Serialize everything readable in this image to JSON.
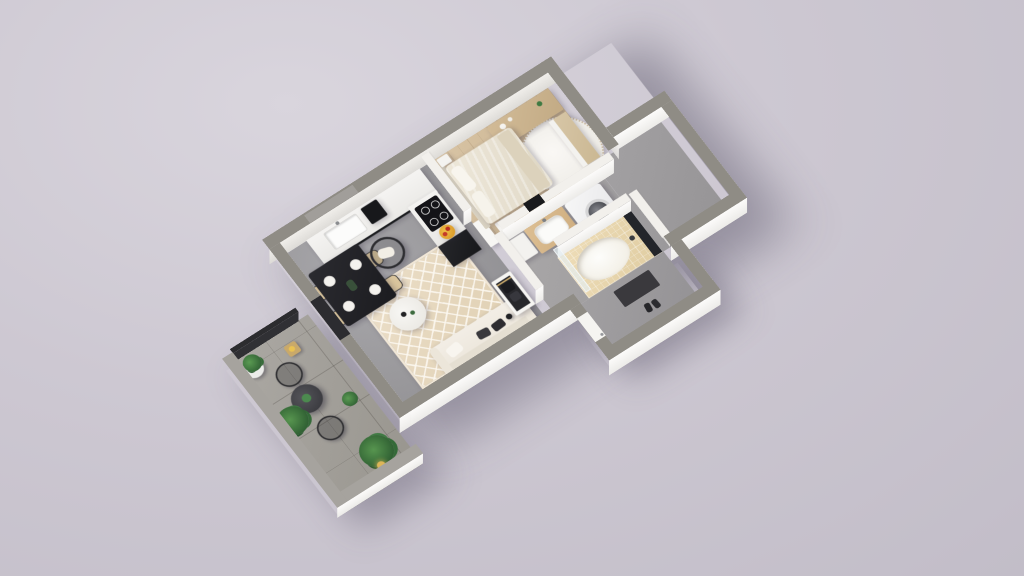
{
  "meta": {
    "type": "isometric 3D apartment floor plan render",
    "view": "top-down isometric, rotated ~35 degrees",
    "visible_text": ""
  },
  "colors": {
    "background": "#cdc8d2",
    "exterior_wall_top": "#8f8c85",
    "interior_wall_top": "#f2f0ec",
    "wall_side_white": "#f7f6f4",
    "concrete_floor": "#9b9a9d",
    "wood_floor": "#d0bb9c",
    "balcony_tile": "#a3a09b",
    "rug_beige": "#e9dcc6",
    "sofa_cream": "#f1ece3",
    "counter_black": "#1d1e21",
    "accent_fruit_bowl": "#e0a52f",
    "plant_green": "#3e7a42"
  },
  "rooms": [
    {
      "name": "living room",
      "floor": "gray concrete"
    },
    {
      "name": "kitchen",
      "floor": "gray concrete"
    },
    {
      "name": "dining area",
      "floor": "gray concrete"
    },
    {
      "name": "bedroom",
      "floor": "light wood planks"
    },
    {
      "name": "bathroom",
      "floor": "gray concrete with beige mosaic tub surround"
    },
    {
      "name": "hallway",
      "floor": "gray concrete"
    },
    {
      "name": "entry vestibule",
      "floor": "gray concrete"
    },
    {
      "name": "balcony",
      "floor": "large gray tiles"
    }
  ],
  "furniture": {
    "living": [
      "diamond-pattern area rug",
      "cream sofa with cushions",
      "round white coffee table",
      "black wire lounge chair with white cushion",
      "black floor lamp",
      "open wardrobe niche with hanging clothes",
      "black dining table",
      "dining chair with beige cushion",
      "white dinner plate",
      "white open door leaf"
    ],
    "kitchen": [
      "white countertop with sink",
      "black coffee machine",
      "black cooktop with four burners",
      "fruit bowl",
      "black base cabinet",
      "gray splashback window"
    ],
    "bedroom": [
      "double bed with cream duvet",
      "white pillow",
      "white nightstand",
      "wooden dresser with decor",
      "round fluffy white rug",
      "wooden wardrobe with white sliding door",
      "beige throw blanket"
    ],
    "bathroom": [
      "white storage cabinet",
      "wood vanity with white sink",
      "black wall mirror",
      "washing machine with round door",
      "beige tiled bathtub",
      "glass shower screen",
      "dark fixture panel"
    ],
    "hall": [
      "dark doormat",
      "white entry door",
      "pair of shoes"
    ],
    "balcony": [
      "round dark bistro table",
      "black wire chair",
      "potted plant in white pot",
      "palm plant",
      "wooden stool with lantern",
      "candle lantern",
      "dark balcony railing"
    ]
  }
}
